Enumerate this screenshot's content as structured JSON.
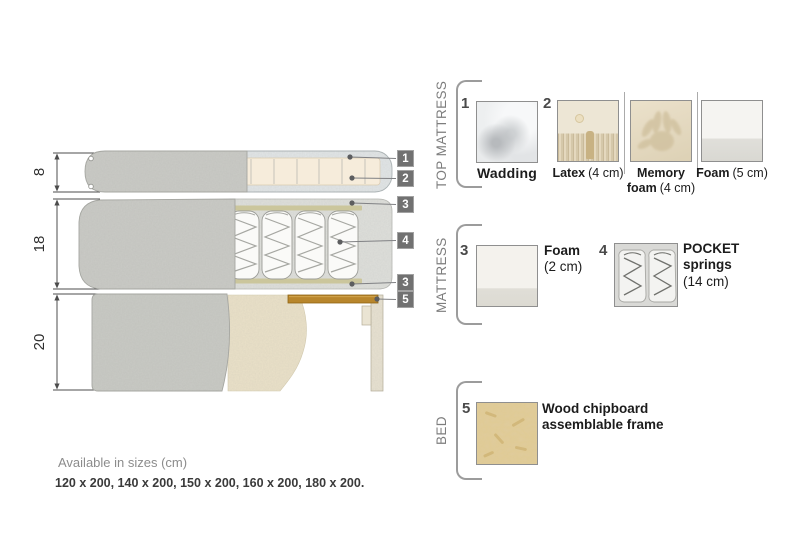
{
  "colors": {
    "fabric_gray": "#cacbc6",
    "foam_cream": "#f6ecdb",
    "wadding_blue_gray": "#e2e6e7",
    "cutaway_gray": "#dfe0dc",
    "spring_foam_line": "#cbc69c",
    "bed_beige": "#ebe2c9",
    "wood_brown": "#b8862c",
    "callout_bg": "#717171",
    "text_dark": "#1c1c1c",
    "text_gray": "#7d7d7d"
  },
  "diagram": {
    "dimensions": {
      "top_mattress": "8",
      "mattress": "18",
      "bed": "20"
    },
    "callouts": {
      "c1": "1",
      "c2": "2",
      "c3": "3",
      "c4": "4",
      "c5": "5"
    }
  },
  "legend": {
    "top_mattress": {
      "title": "TOP MATTRESS",
      "item1_num": "1",
      "wadding_name": "Wadding",
      "item2_num": "2",
      "latex_name": "Latex",
      "latex_size": "(4 cm)",
      "memory_name": "Memory foam",
      "memory_size": "(4 cm)",
      "foam_name": "Foam",
      "foam_size": "(5 cm)"
    },
    "mattress": {
      "title": "MATTRESS",
      "item3_num": "3",
      "foam_name": "Foam",
      "foam_size": "(2 cm)",
      "item4_num": "4",
      "pocket_name": "POCKET springs",
      "pocket_size": "(14 cm)"
    },
    "bed": {
      "title": "BED",
      "item5_num": "5",
      "wood_name": "Wood chipboard assemblable frame"
    }
  },
  "footer": {
    "sizes_title": "Available in sizes (cm)",
    "sizes_list": "120 x 200, 140 x 200, 150 x 200, 160 x 200, 180 x 200."
  }
}
